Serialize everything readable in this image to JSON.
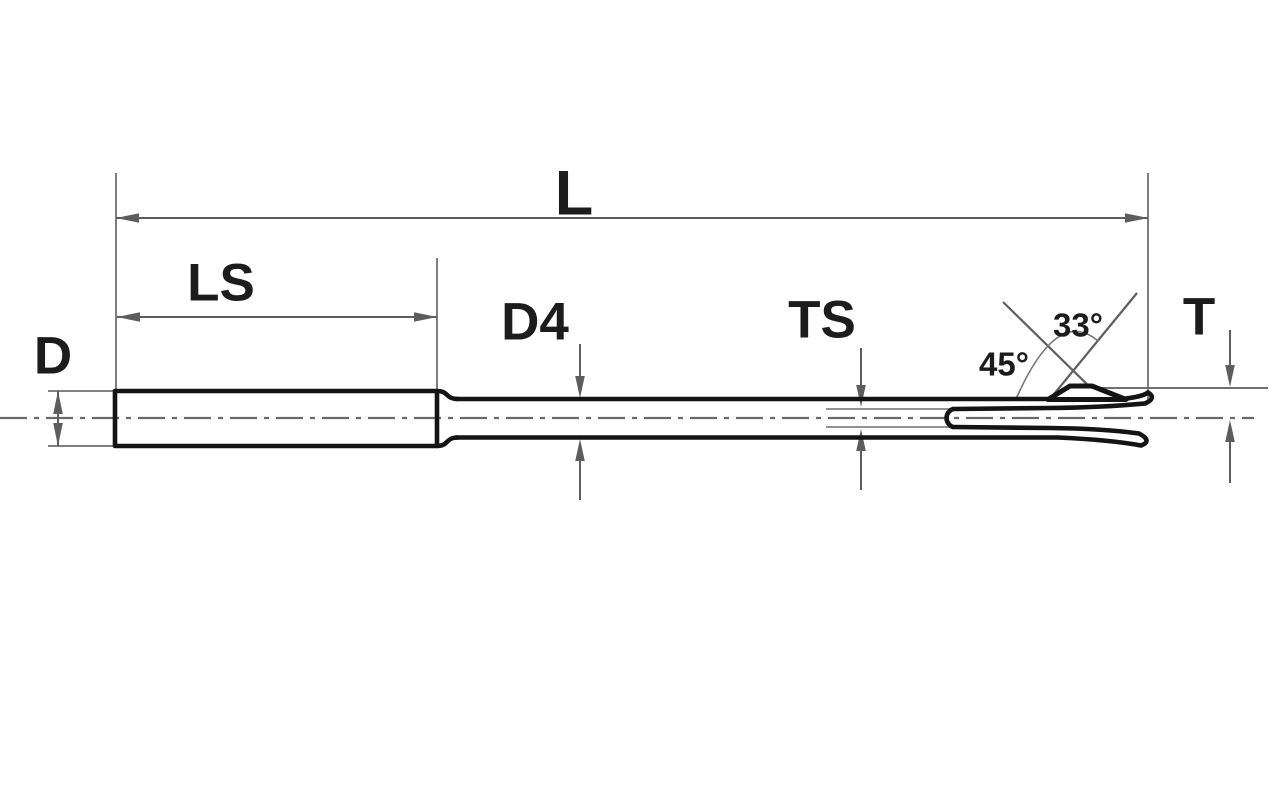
{
  "diagram": {
    "dimension_labels": {
      "overall_length": "L",
      "shank_length": "LS",
      "shank_diameter": "D",
      "shaft_diameter": "D4",
      "slot_thickness": "TS",
      "tip_height": "T"
    },
    "angle_labels": {
      "secondary_angle": "33°",
      "primary_angle": "45°"
    },
    "colors": {
      "background": "#ffffff",
      "part_outline": "#141414",
      "dimension_lines": "#5d5d5d",
      "centerline": "#6a6a6a",
      "label_text": "#1c1c1c"
    }
  }
}
